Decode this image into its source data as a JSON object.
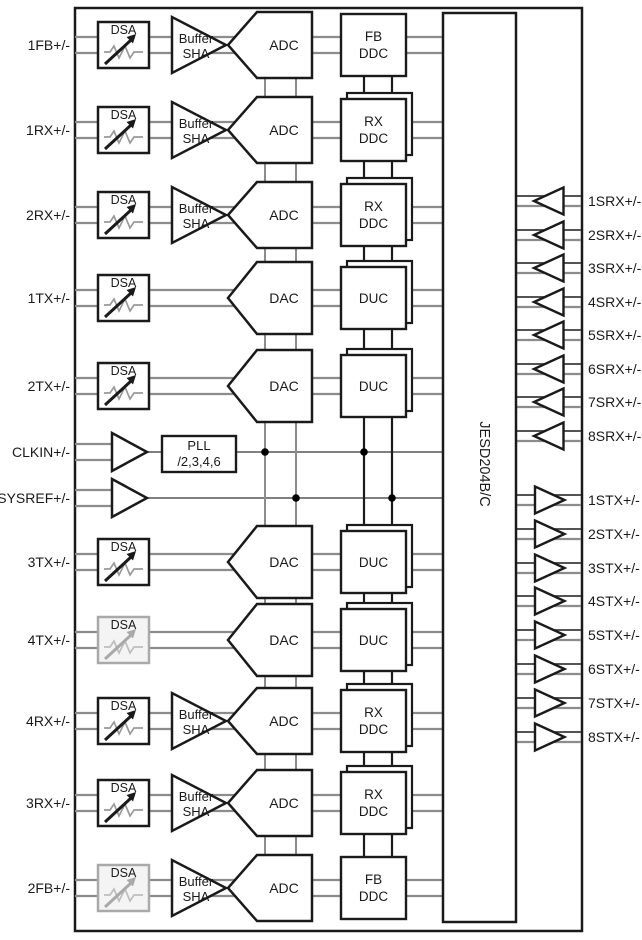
{
  "figure": {
    "type": "functional-block-diagram",
    "jesd_block_label": "JESD204B/C",
    "block_labels": {
      "dsa": "DSA",
      "buffer": [
        "Buffer",
        "SHA"
      ],
      "adc": "ADC",
      "dac": "DAC",
      "pll": [
        "PLL",
        "/2,3,4,6"
      ],
      "fb_ddc": [
        "FB",
        "DDC"
      ],
      "rx_ddc": [
        "RX",
        "DDC"
      ],
      "duc": [
        "DUC"
      ]
    },
    "left_ports": [
      {
        "label": "1FB+/-",
        "y": 45,
        "chain": "adc",
        "dsp": "fb_ddc",
        "dsp_stacked": false,
        "buffer": true,
        "dsa": "normal"
      },
      {
        "label": "1RX+/-",
        "y": 130,
        "chain": "adc",
        "dsp": "rx_ddc",
        "dsp_stacked": true,
        "buffer": true,
        "dsa": "normal"
      },
      {
        "label": "2RX+/-",
        "y": 215,
        "chain": "adc",
        "dsp": "rx_ddc",
        "dsp_stacked": true,
        "buffer": true,
        "dsa": "normal"
      },
      {
        "label": "1TX+/-",
        "y": 298,
        "chain": "dac",
        "dsp": "duc",
        "dsp_stacked": true,
        "buffer": false,
        "dsa": "normal"
      },
      {
        "label": "2TX+/-",
        "y": 386,
        "chain": "dac",
        "dsp": "duc",
        "dsp_stacked": true,
        "buffer": false,
        "dsa": "normal"
      },
      {
        "label": "3TX+/-",
        "y": 562,
        "chain": "dac",
        "dsp": "duc",
        "dsp_stacked": true,
        "buffer": false,
        "dsa": "normal"
      },
      {
        "label": "4TX+/-",
        "y": 640,
        "chain": "dac",
        "dsp": "duc",
        "dsp_stacked": true,
        "buffer": false,
        "dsa": "grayed"
      },
      {
        "label": "4RX+/-",
        "y": 721,
        "chain": "adc",
        "dsp": "rx_ddc",
        "dsp_stacked": true,
        "buffer": true,
        "dsa": "normal"
      },
      {
        "label": "3RX+/-",
        "y": 803,
        "chain": "adc",
        "dsp": "rx_ddc",
        "dsp_stacked": true,
        "buffer": true,
        "dsa": "normal"
      },
      {
        "label": "2FB+/-",
        "y": 888,
        "chain": "adc",
        "dsp": "fb_ddc",
        "dsp_stacked": false,
        "buffer": true,
        "dsa": "grayed"
      }
    ],
    "clock_ports": [
      {
        "label": "CLKIN+/-",
        "y": 452,
        "has_pll": true
      },
      {
        "label": "SYSREF+/-",
        "y": 498,
        "has_pll": false
      }
    ],
    "serdes_rx_ports": [
      {
        "label": "1SRX+/-",
        "y": 201
      },
      {
        "label": "2SRX+/-",
        "y": 235
      },
      {
        "label": "3SRX+/-",
        "y": 268
      },
      {
        "label": "4SRX+/-",
        "y": 302
      },
      {
        "label": "5SRX+/-",
        "y": 335
      },
      {
        "label": "6SRX+/-",
        "y": 369
      },
      {
        "label": "7SRX+/-",
        "y": 402
      },
      {
        "label": "8SRX+/-",
        "y": 436
      }
    ],
    "serdes_tx_ports": [
      {
        "label": "1STX+/-",
        "y": 500
      },
      {
        "label": "2STX+/-",
        "y": 534
      },
      {
        "label": "3STX+/-",
        "y": 568
      },
      {
        "label": "4STX+/-",
        "y": 601
      },
      {
        "label": "5STX+/-",
        "y": 635
      },
      {
        "label": "6STX+/-",
        "y": 669
      },
      {
        "label": "7STX+/-",
        "y": 703
      },
      {
        "label": "8STX+/-",
        "y": 737
      }
    ],
    "colors": {
      "stroke": "#1a1a1a",
      "wire": "#8c8c8c",
      "wire_dark": "#3c3c3c",
      "clock_wire": "#6e6e6e",
      "grayed": "#a9a9a9",
      "grayed_zigzag": "#bdbdbd",
      "grayed_fill": "#f4f4f4",
      "grayed_text": "#4a4a4a",
      "background": "#ffffff"
    }
  }
}
